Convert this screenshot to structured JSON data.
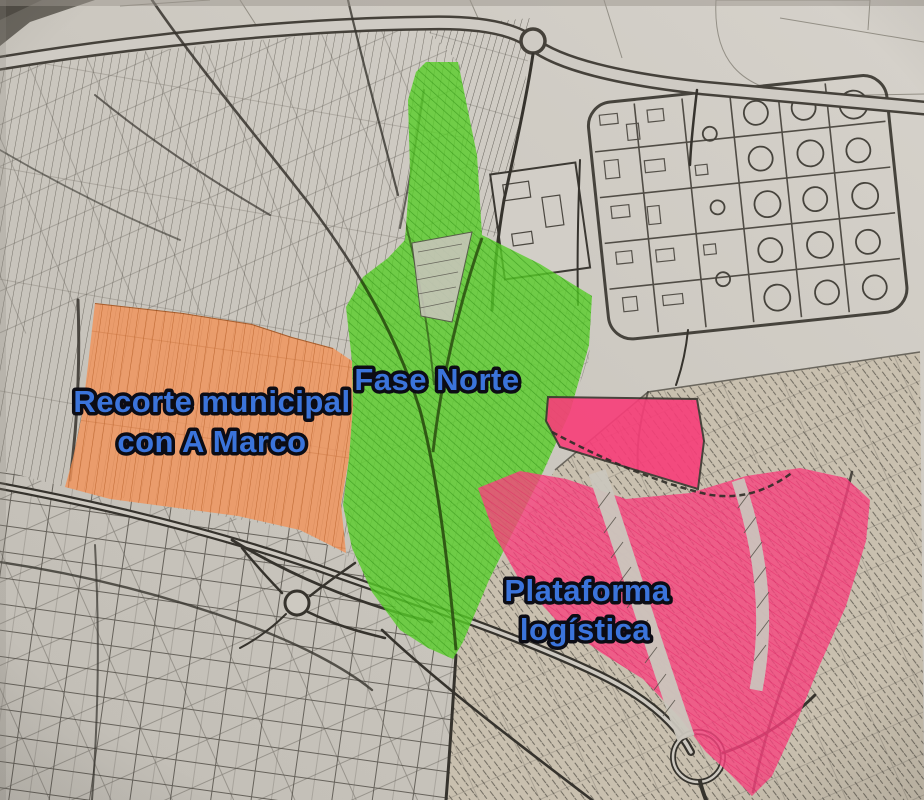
{
  "map": {
    "description_kind": "scanned-cadastral-plan-photo-with-highlighter-zones",
    "colors": {
      "paper": "#CCC8C0",
      "ink": "#36332D",
      "orange_zone": "#F2945A",
      "green_zone": "#58CD28",
      "pink_zone": "#F8437E",
      "pink_zone_solid": "#F83E79",
      "label_fill": "#3B74DB",
      "label_outline": "#0C0C14"
    },
    "zones": [
      {
        "id": "recorte-municipal-con-a-marco",
        "label_lines": [
          "Recorte municipal",
          "con A Marco"
        ],
        "color": "#F2945A"
      },
      {
        "id": "fase-norte",
        "label_lines": [
          "Fase Norte"
        ],
        "color": "#58CD28"
      },
      {
        "id": "plataforma-logistica",
        "label_lines": [
          "Plataforma",
          "logística"
        ],
        "color": "#F8437E"
      }
    ],
    "features": [
      "cadastral-parcel-strips",
      "tank-farm-industrial-area",
      "top-highway-with-roundabout",
      "south-highway-interchange-roundabout",
      "railway-diagonals",
      "south-east-hatched-parcels"
    ]
  }
}
